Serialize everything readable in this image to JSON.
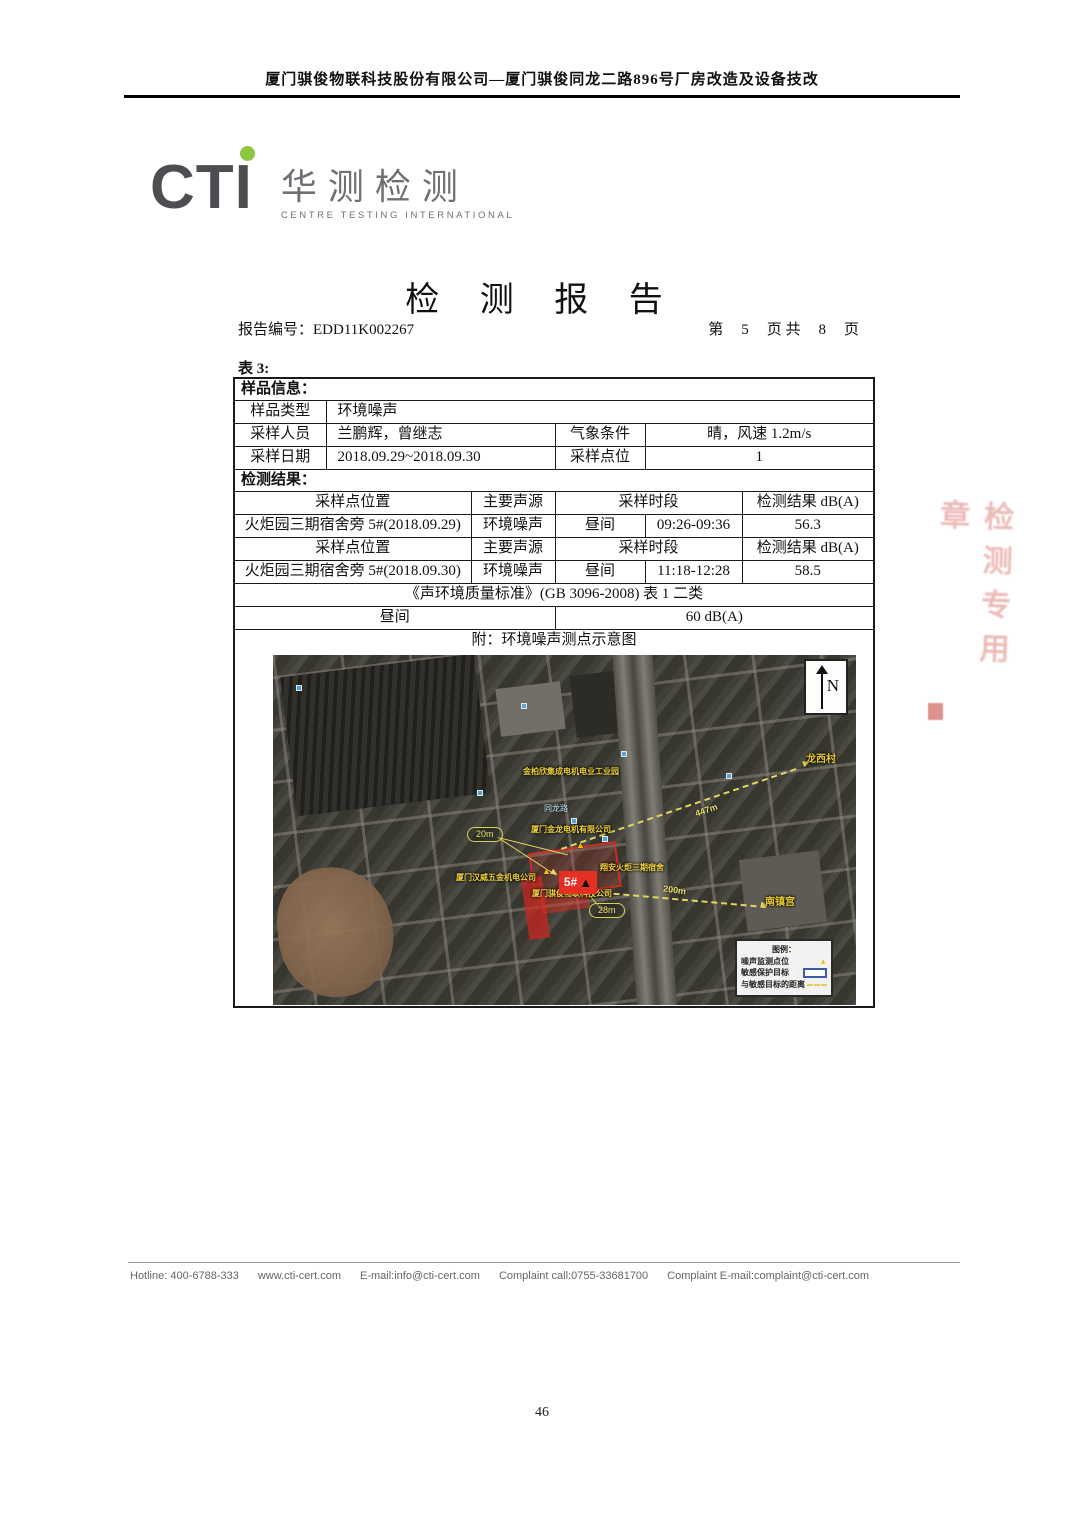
{
  "header": {
    "title": "厦门骐俊物联科技股份有限公司—厦门骐俊同龙二路896号厂房改造及设备技改"
  },
  "logo": {
    "acronym": "CTI",
    "cn": "华测检测",
    "en": "CENTRE TESTING INTERNATIONAL",
    "accent_green": "#8dc63f"
  },
  "report": {
    "title": "检 测 报 告",
    "no_label": "报告编号：",
    "no": "EDD11K002267",
    "page_prefix": "第",
    "page_current": "5",
    "page_mid": "页 共",
    "page_total": "8",
    "page_suffix": "页"
  },
  "table": {
    "caption": "表 3:",
    "section1_title": "样品信息：",
    "sample_type_label": "样品类型",
    "sample_type_value": "环境噪声",
    "sampler_label": "采样人员",
    "sampler_value": "兰鹏辉，曾继志",
    "weather_label": "气象条件",
    "weather_value": "晴，风速 1.2m/s",
    "date_label": "采样日期",
    "date_value": "2018.09.29~2018.09.30",
    "points_label": "采样点位",
    "points_value": "1",
    "section2_title": "检测结果：",
    "result_headers": {
      "location": "采样点位置",
      "source": "主要声源",
      "period": "采样时段",
      "result": "检测结果 dB(A)"
    },
    "results": [
      {
        "location": "火炬园三期宿舍旁 5#(2018.09.29)",
        "source": "环境噪声",
        "period": "昼间",
        "time": "09:26-09:36",
        "value": "56.3"
      },
      {
        "location": "火炬园三期宿舍旁 5#(2018.09.30)",
        "source": "环境噪声",
        "period": "昼间",
        "time": "11:18-12:28",
        "value": "58.5"
      }
    ],
    "standard_row": "《声环境质量标准》(GB 3096-2008)  表 1  二类",
    "limit_period": "昼间",
    "limit_value": "60 dB(A)",
    "attachment_note": "附：环境噪声测点示意图"
  },
  "map": {
    "north": "N",
    "labels": {
      "village": "龙西村",
      "temple": "南镇宫",
      "road": "同龙路",
      "factory_top": "金柏欣集成电机电业工业园",
      "factory_mid": "厦门金龙电机有限公司",
      "factory_left": "厦门汉威五金机电公司",
      "dorm": "翔安火炬三期宿舍",
      "site": "厦门骐俊物联科技公司",
      "marker": "5#",
      "marker_triangle": "▲",
      "point_triangle": "▲",
      "d20": "20m",
      "d28": "28m",
      "d200": "200m",
      "d447": "447m"
    },
    "legend": {
      "title": "图例：",
      "noise_point": "噪声监测点位",
      "sensitive_target": "敏感保护目标",
      "distance": "与敏感目标的距离"
    }
  },
  "stamp": {
    "fragment": "检测专用章"
  },
  "footer": {
    "items": [
      "Hotline: 400-6788-333",
      "www.cti-cert.com",
      "E-mail:info@cti-cert.com",
      "Complaint call:0755-33681700",
      "Complaint E-mail:complaint@cti-cert.com"
    ]
  },
  "page_number": "46"
}
